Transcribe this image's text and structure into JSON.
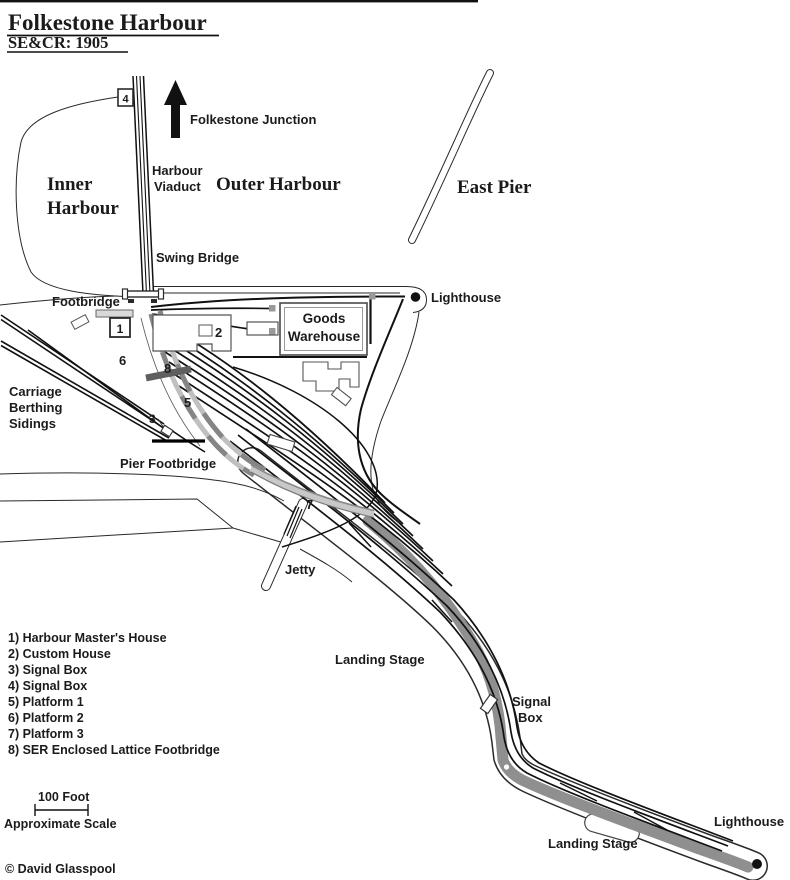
{
  "page": {
    "top_title": "Folkestone Harbour",
    "subtitle": "SE&CR: 1905",
    "copyright": "© David Glasspool"
  },
  "labels": {
    "folkestone_junction": "Folkestone Junction",
    "harbour_viaduct_1": "Harbour",
    "harbour_viaduct_2": "Viaduct",
    "inner_harbour_1": "Inner",
    "inner_harbour_2": "Harbour",
    "outer_harbour": "Outer Harbour",
    "east_pier": "East Pier",
    "swing_bridge": "Swing Bridge",
    "footbridge": "Footbridge",
    "lighthouse_outer_harbour": "Lighthouse",
    "goods_warehouse_1": "Goods",
    "goods_warehouse_2": "Warehouse",
    "carriage_sidings_1": "Carriage",
    "carriage_sidings_2": "Berthing",
    "carriage_sidings_3": "Sidings",
    "pier_footbridge": "Pier Footbridge",
    "jetty": "Jetty",
    "landing_stage_upper": "Landing Stage",
    "signal_box_1": "Signal",
    "signal_box_2": "Box",
    "lighthouse_pier": "Lighthouse",
    "landing_stage_lower": "Landing Stage"
  },
  "markers": {
    "n1": "1",
    "n2": "2",
    "n3": "3",
    "n4": "4",
    "n5": "5",
    "n6": "6",
    "n7": "7",
    "n8": "8"
  },
  "legend": {
    "items": [
      "1) Harbour Master's House",
      "2) Custom House",
      "3) Signal Box",
      "4) Signal Box",
      "5) Platform 1",
      "6) Platform 2",
      "7) Platform 3",
      "8) SER Enclosed Lattice Footbridge"
    ]
  },
  "scale": {
    "distance": "100 Foot",
    "caption": "Approximate Scale"
  },
  "colors": {
    "ink": "#1b1b1b",
    "platform": "#c0c0c0",
    "platform_dark": "#858585",
    "landing_stage": "#8f8f8f",
    "marker_gray": "#999999"
  }
}
